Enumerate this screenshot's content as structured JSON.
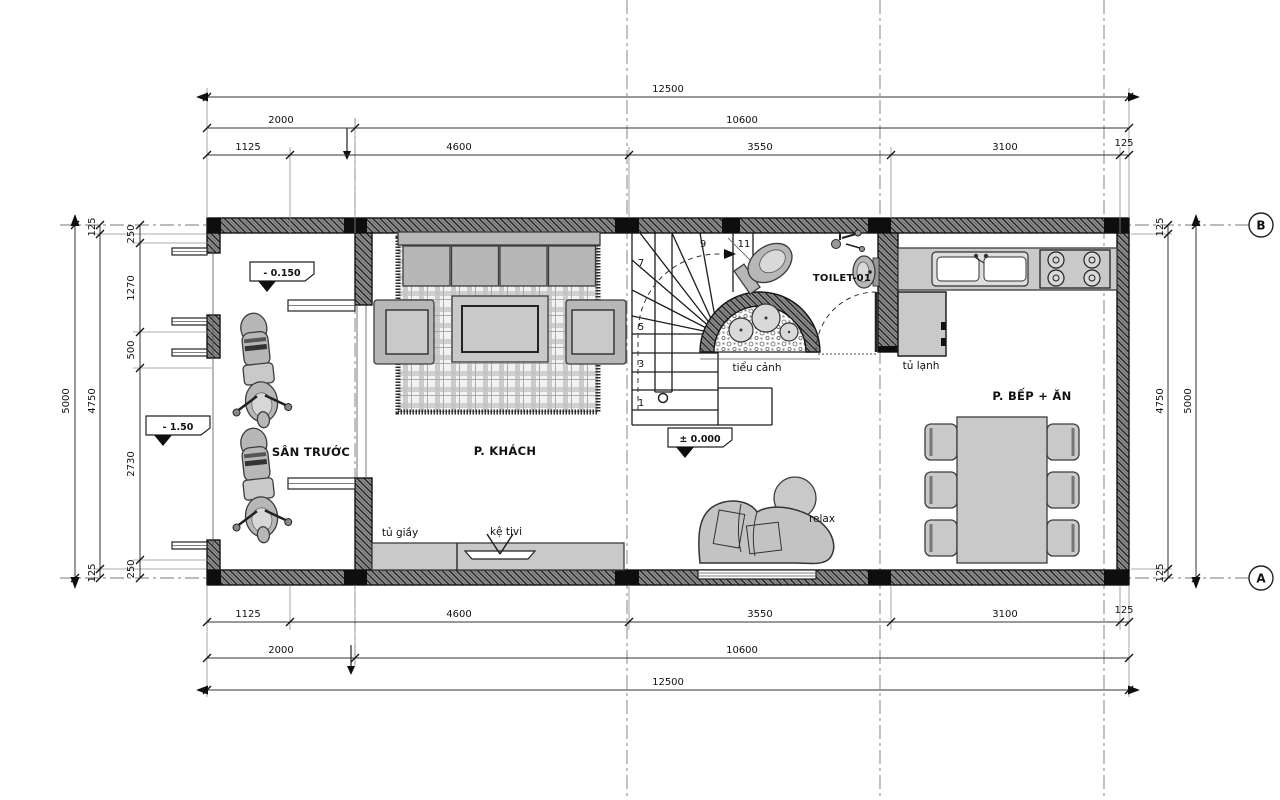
{
  "rooms": {
    "front_yard": "SÂN TRƯỚC",
    "living": "P. KHÁCH",
    "toilet": "TOILET-01",
    "kitchen_dining": "P. BẾP + ĂN"
  },
  "annotations": {
    "shoe_cabinet": "tủ giầy",
    "tv_shelf": "kệ tivi",
    "mini_garden": "tiểu cảnh",
    "fridge": "tủ lạnh",
    "relax": "relax"
  },
  "levels": {
    "front_yard": "- 0.150",
    "street": "- 1.50",
    "ground_floor": "± 0.000"
  },
  "stairs": {
    "step_numbers": [
      "1",
      "3",
      "5",
      "7",
      "9",
      "11"
    ]
  },
  "grid": {
    "bubble_top": "B",
    "bubble_bottom": "A"
  },
  "dimensions": {
    "top": {
      "total": "12500",
      "row2": [
        "2000",
        "10600"
      ],
      "row3": [
        "1125",
        "4600",
        "3550",
        "3100",
        "125"
      ]
    },
    "bottom": {
      "total": "12500",
      "row2": [
        "2000",
        "10600"
      ],
      "row3": [
        "1125",
        "4600",
        "3550",
        "3100",
        "125"
      ]
    },
    "left": {
      "total": "5000",
      "inner": [
        "125",
        "4750",
        "125"
      ],
      "detail": [
        "250",
        "1270",
        "500",
        "2730",
        "250"
      ]
    },
    "right": {
      "total": "5000",
      "inner": [
        "125",
        "4750",
        "125"
      ]
    }
  },
  "colors": {
    "line": "#1c1c1c",
    "furniture_fill": "#b7b7b7",
    "counter_fill": "#c9c9c9",
    "background": "#ffffff"
  }
}
